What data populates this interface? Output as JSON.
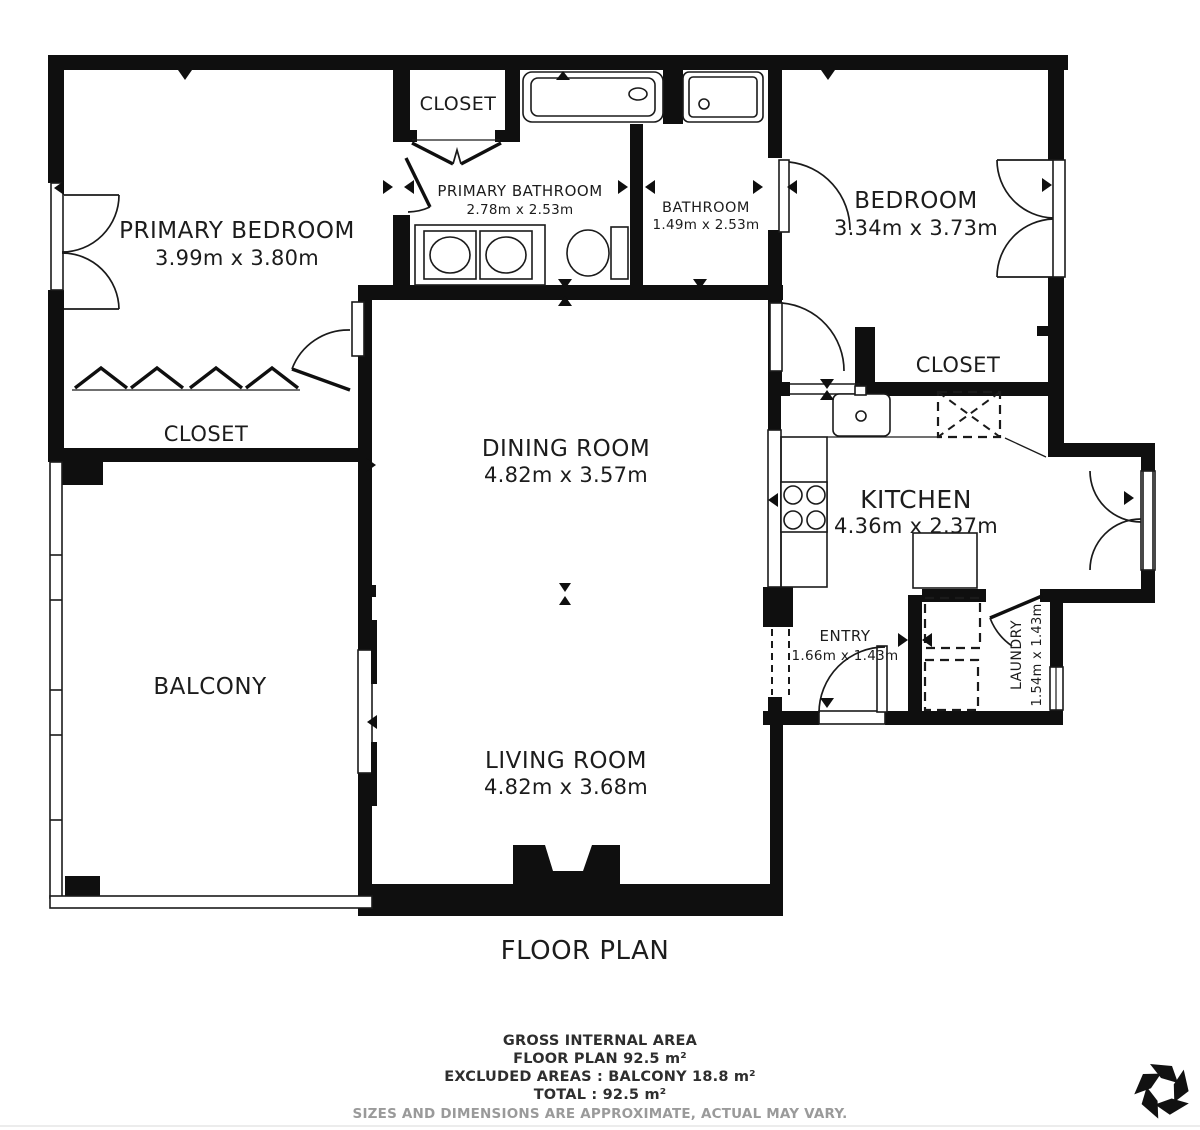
{
  "plan": {
    "title": "FLOOR PLAN",
    "rooms": [
      {
        "id": "primary-bedroom",
        "name": "PRIMARY BEDROOM",
        "dims": "3.99m x 3.80m"
      },
      {
        "id": "closet-top",
        "name": "CLOSET",
        "dims": ""
      },
      {
        "id": "primary-bathroom",
        "name": "PRIMARY BATHROOM",
        "dims": "2.78m x 2.53m"
      },
      {
        "id": "bathroom",
        "name": "BATHROOM",
        "dims": "1.49m x 2.53m"
      },
      {
        "id": "bedroom",
        "name": "BEDROOM",
        "dims": "3.34m x 3.73m"
      },
      {
        "id": "closet-bedroom",
        "name": "CLOSET",
        "dims": ""
      },
      {
        "id": "closet-hall",
        "name": "CLOSET",
        "dims": ""
      },
      {
        "id": "dining-room",
        "name": "DINING ROOM",
        "dims": "4.82m x 3.57m"
      },
      {
        "id": "kitchen",
        "name": "KITCHEN",
        "dims": "4.36m x 2.37m"
      },
      {
        "id": "balcony",
        "name": "BALCONY",
        "dims": ""
      },
      {
        "id": "entry",
        "name": "ENTRY",
        "dims": "1.66m x 1.43m"
      },
      {
        "id": "laundry",
        "name": "LAUNDRY",
        "dims": "1.54m x 1.43m"
      },
      {
        "id": "living-room",
        "name": "LIVING ROOM",
        "dims": "4.82m x 3.68m"
      }
    ],
    "summary": {
      "area_title": "GROSS INTERNAL AREA",
      "floor_plan": "FLOOR PLAN 92.5 m²",
      "excluded": "EXCLUDED AREAS :  BALCONY 18.8 m²",
      "total": "TOTAL :  92.5 m²",
      "disclaimer": "SIZES AND DIMENSIONS ARE APPROXIMATE, ACTUAL MAY VARY."
    },
    "logo_icon": "pinwheel-star-logo",
    "colors": {
      "wall": "#0f0f0f",
      "text": "#1c1c1c",
      "muted": "#9a9a9a",
      "background": "#ffffff"
    }
  }
}
